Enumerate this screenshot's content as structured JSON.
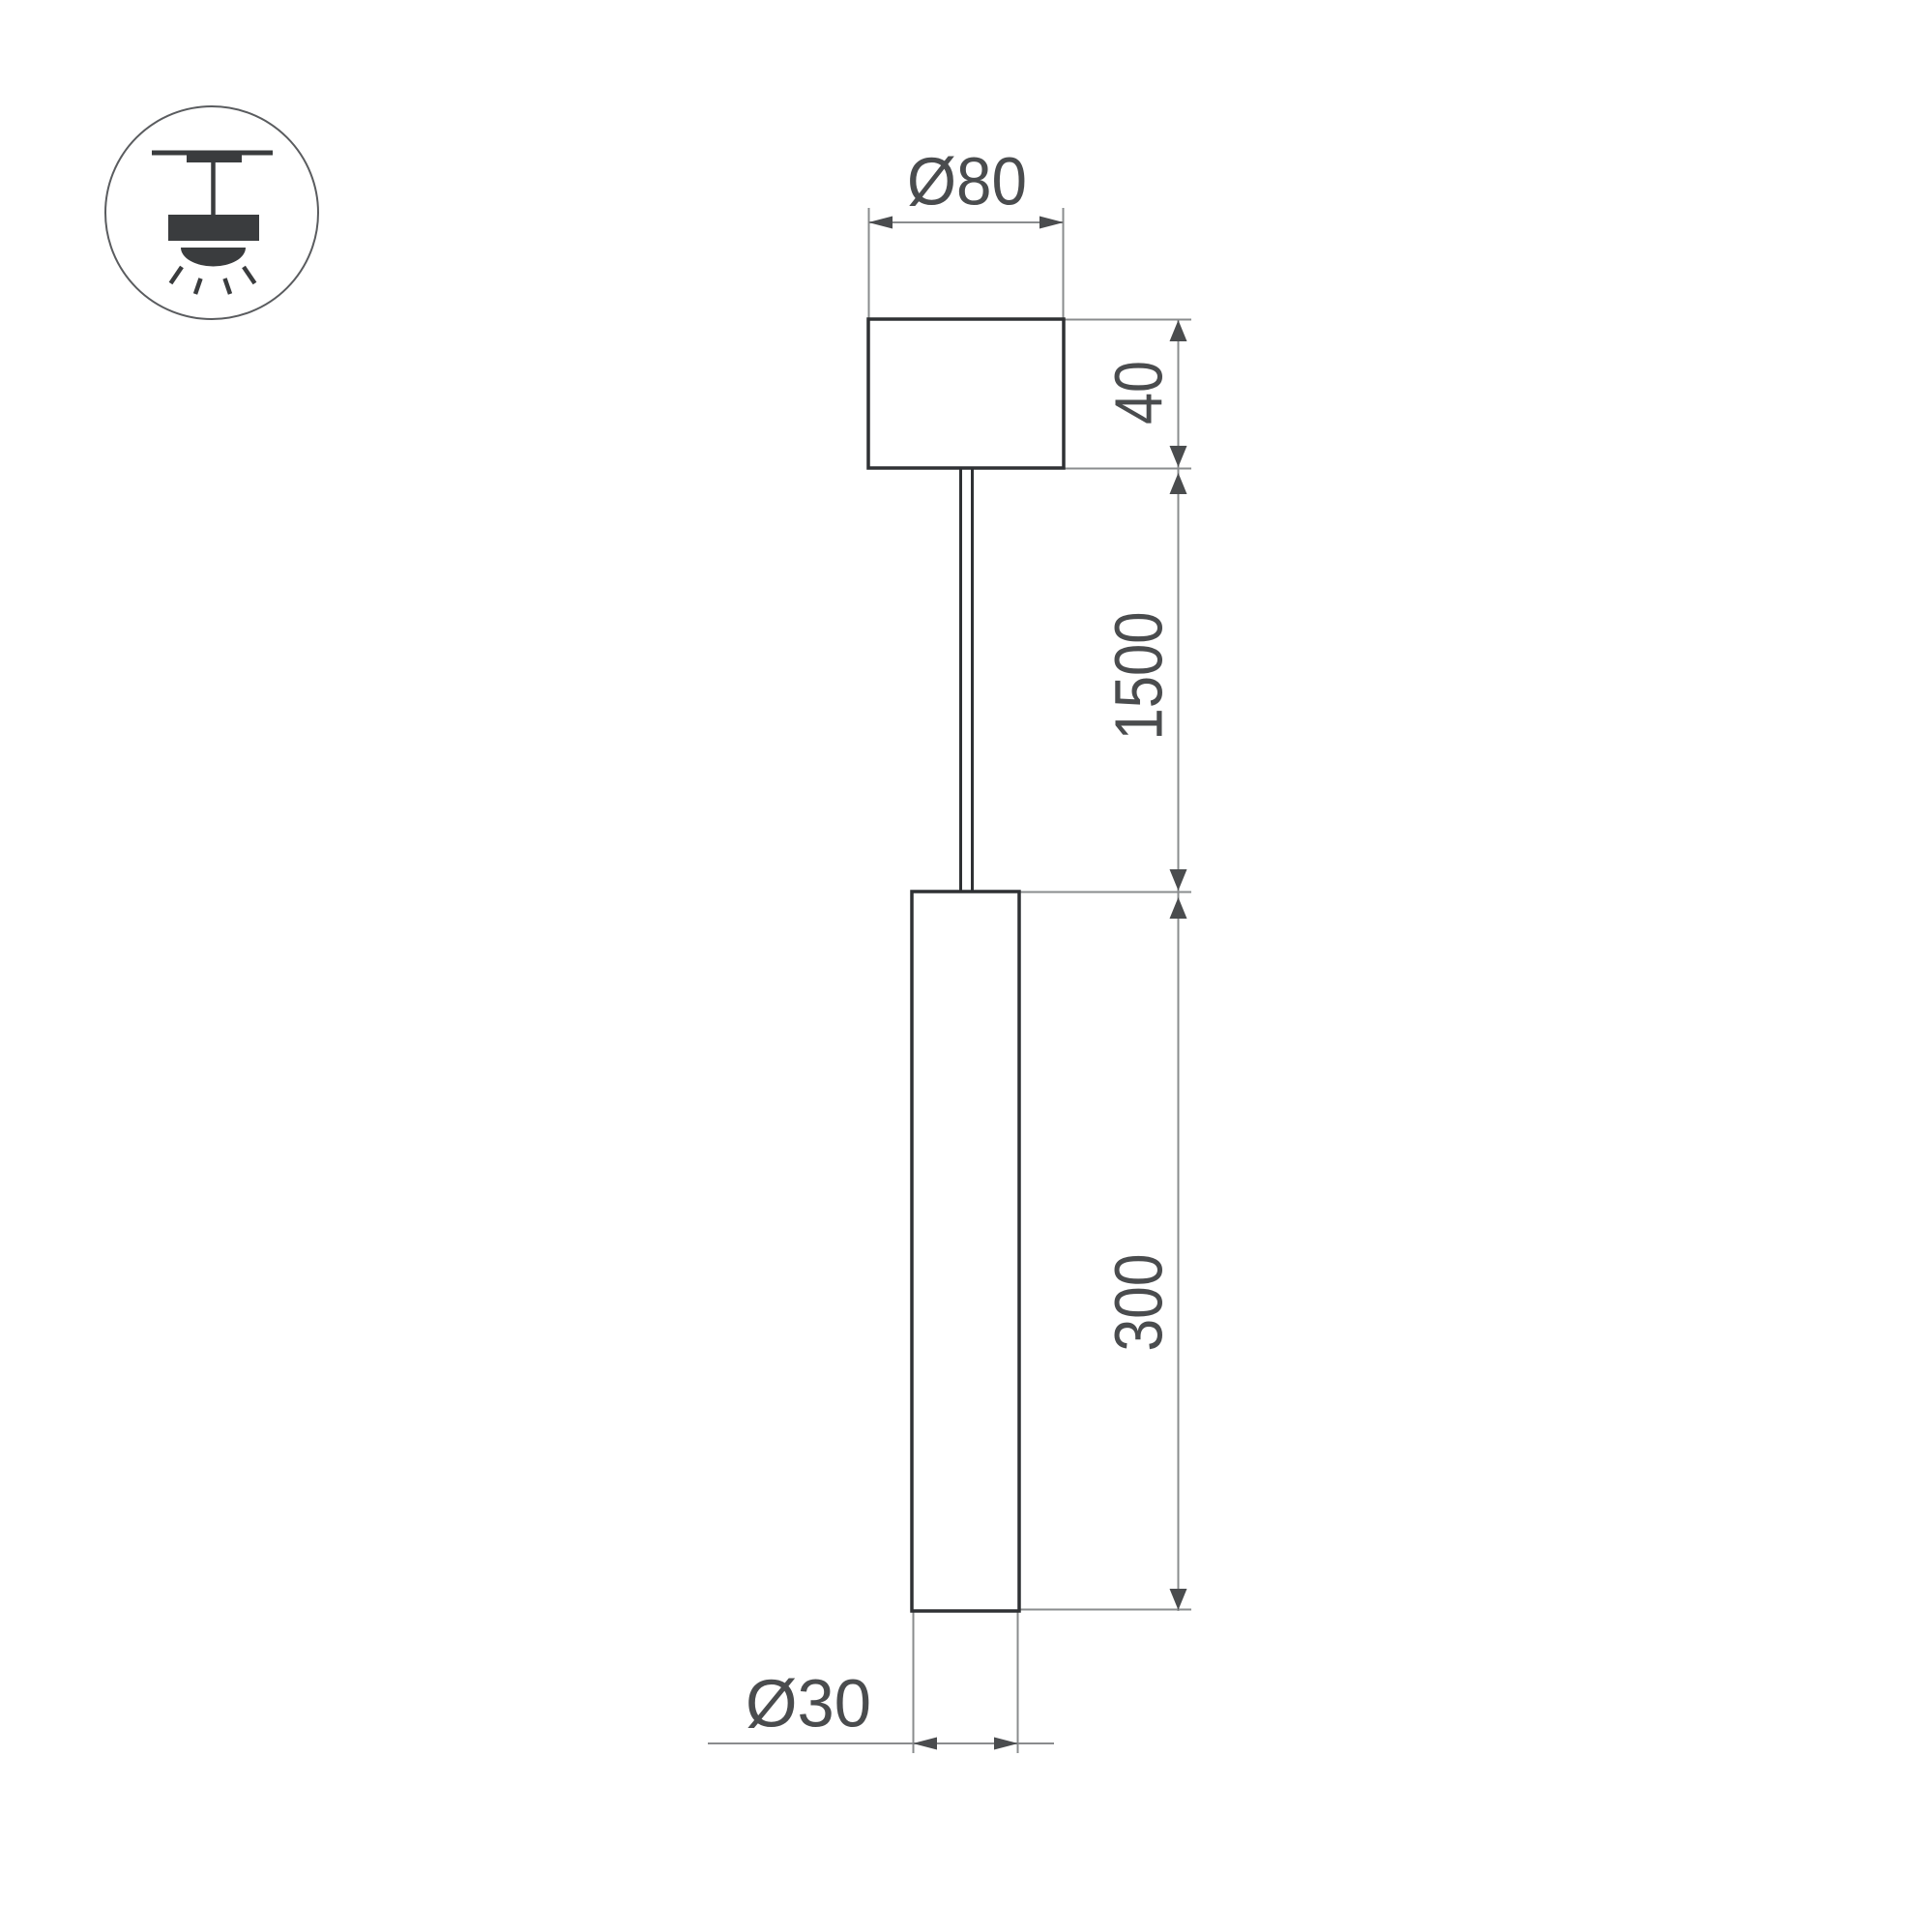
{
  "drawing": {
    "title": "pendant-lamp-dimension-drawing",
    "icon": {
      "name": "pendant-ceiling-light-icon"
    },
    "dimensions": {
      "canopy_diameter": "Ø80",
      "canopy_height": "40",
      "suspension_length": "1500",
      "tube_length": "300",
      "tube_diameter": "Ø30"
    },
    "colors": {
      "outline": "#2f3134",
      "icon_fill": "#3a3c3e",
      "icon_circle": "#5a5c5f",
      "dimension_line": "#8a8c8e",
      "label_and_arrow": "#4a4c4e",
      "background": "#ffffff"
    }
  }
}
